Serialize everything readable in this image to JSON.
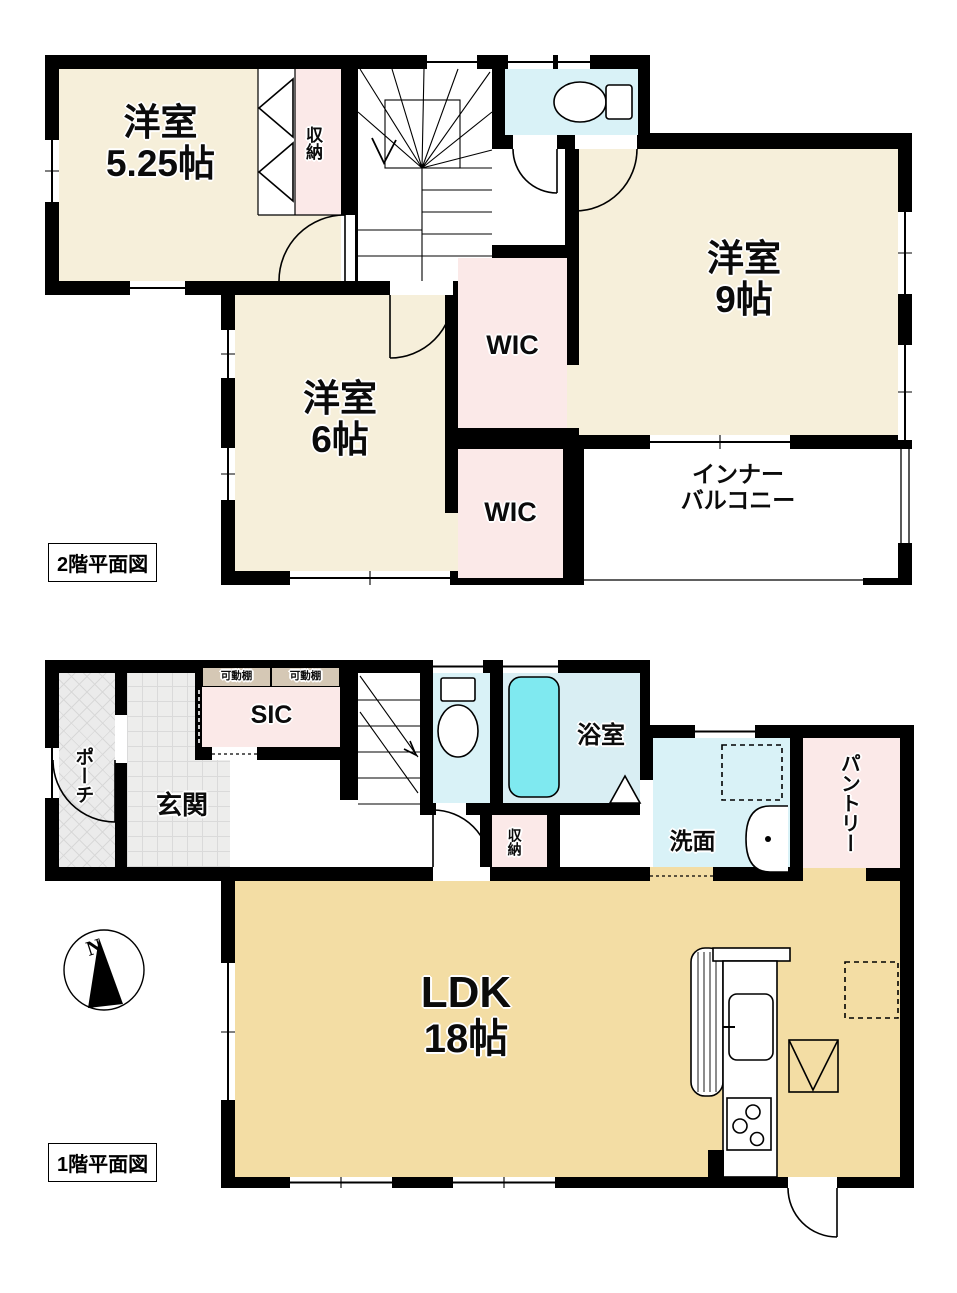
{
  "colors": {
    "wall": "#000000",
    "room_cream": "#f6efda",
    "closet_pink": "#fbe9e8",
    "water_cyan": "#d9f2f7",
    "bath_cyan": "#d9eef3",
    "bath_tub": "#7fe9f0",
    "ldk_tan": "#f3dda4",
    "shelf_tan": "#d5c8b5"
  },
  "floor2": {
    "plan_label": "2階平面図",
    "room_525": {
      "name": "洋室",
      "size": "5.25帖"
    },
    "closet": {
      "name": "収納"
    },
    "room_9": {
      "name": "洋室",
      "size": "9帖"
    },
    "wic_upper": {
      "name": "WIC"
    },
    "room_6": {
      "name": "洋室",
      "size": "6帖"
    },
    "wic_lower": {
      "name": "WIC"
    },
    "balcony": {
      "line1": "インナー",
      "line2": "バルコニー"
    }
  },
  "floor1": {
    "plan_label": "1階平面図",
    "porch": {
      "name": "ポーチ"
    },
    "entrance": {
      "name": "玄関"
    },
    "sic": {
      "name": "SIC"
    },
    "shelf_left": {
      "name": "可動棚"
    },
    "shelf_right": {
      "name": "可動棚"
    },
    "bathroom": {
      "name": "浴室"
    },
    "washroom": {
      "name": "洗面"
    },
    "closet": {
      "name": "収納"
    },
    "pantry": {
      "name": "パントリー"
    },
    "ldk": {
      "name": "LDK",
      "size": "18帖"
    },
    "compass": {
      "north": "N"
    }
  }
}
